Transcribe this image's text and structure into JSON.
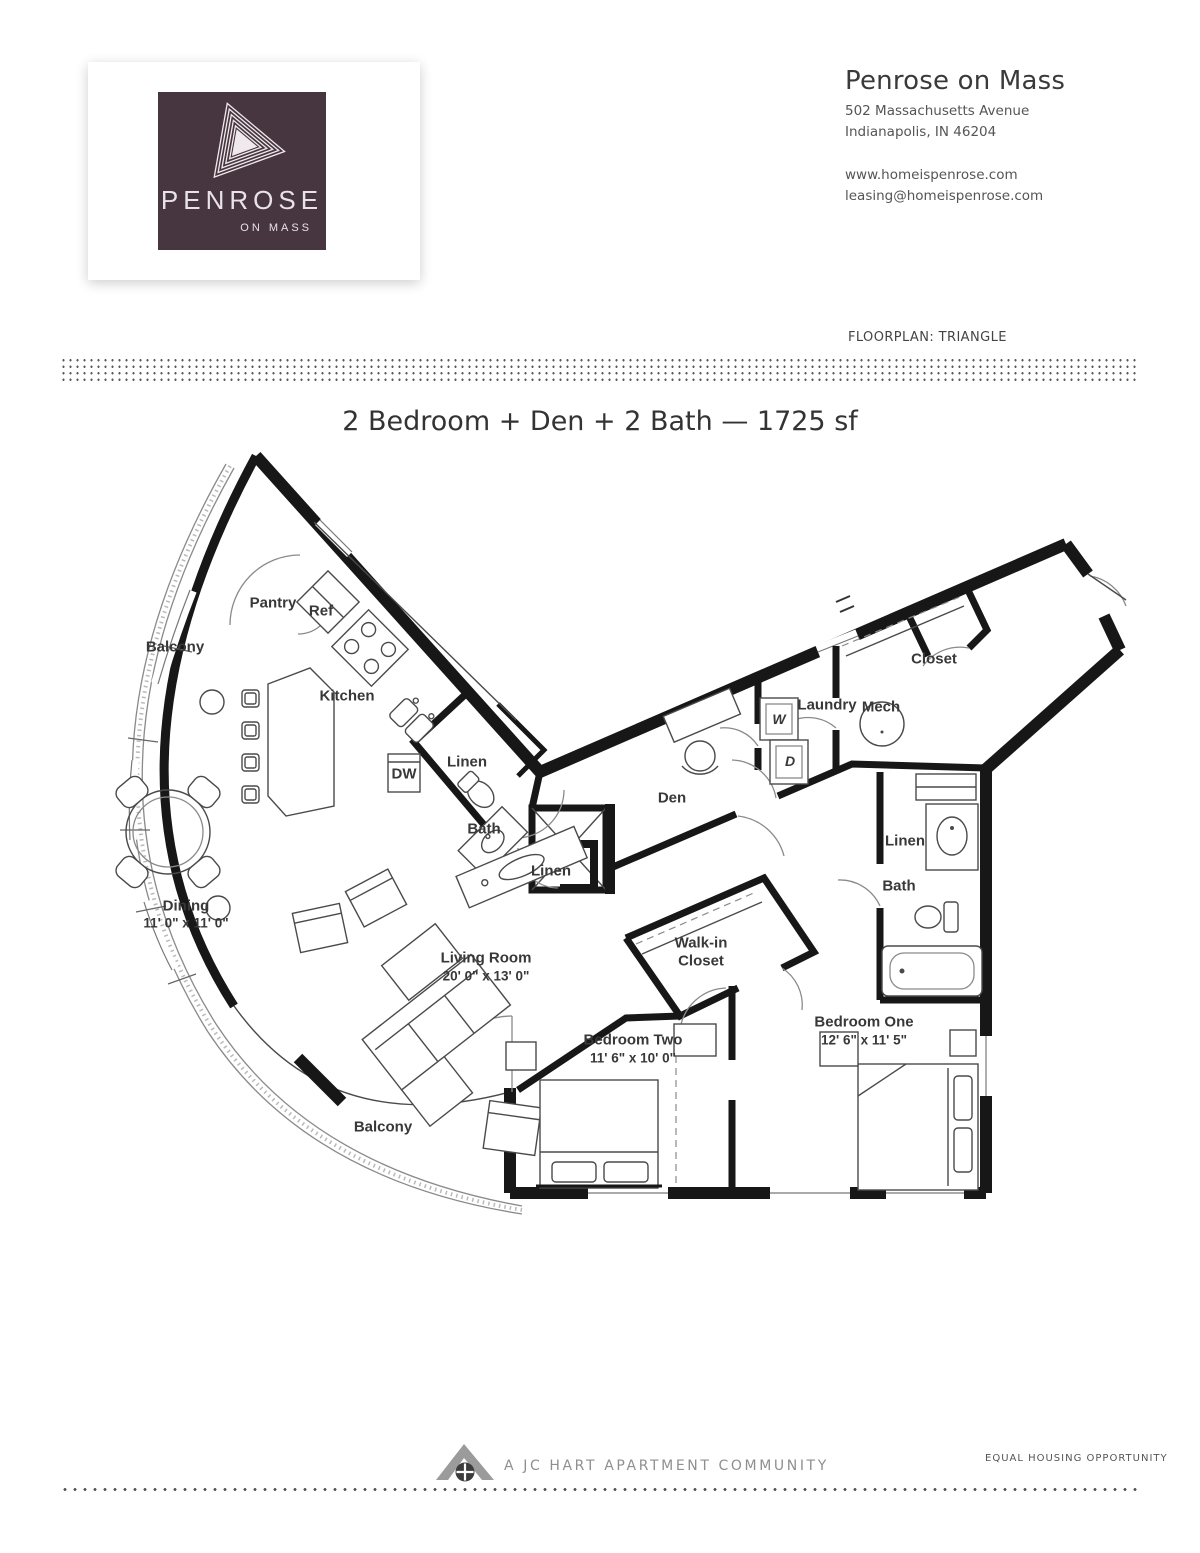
{
  "header": {
    "logo": {
      "brand": "PENROSE",
      "sub": "ON MASS",
      "bg_color": "#47363f"
    },
    "property_name": "Penrose on Mass",
    "address_line1": "502 Massachusetts Avenue",
    "address_line2": "Indianapolis, IN 46204",
    "website": "www.homeispenrose.com",
    "email": "leasing@homeispenrose.com",
    "floorplan_label": "FLOORPLAN: TRIANGLE"
  },
  "title": "2 Bedroom + Den + 2 Bath — 1725 sf",
  "plan": {
    "wall_color": "#171717",
    "labels": [
      {
        "id": "balcony-upper",
        "text": "Balcony"
      },
      {
        "id": "pantry",
        "text": "Pantry"
      },
      {
        "id": "ref",
        "text": "Ref"
      },
      {
        "id": "kitchen",
        "text": "Kitchen"
      },
      {
        "id": "dw",
        "text": "DW"
      },
      {
        "id": "linen-kitchen",
        "text": "Linen"
      },
      {
        "id": "bath-main",
        "text": "Bath"
      },
      {
        "id": "linen-hall",
        "text": "Linen"
      },
      {
        "id": "den",
        "text": "Den"
      },
      {
        "id": "washer",
        "text": "W"
      },
      {
        "id": "dryer",
        "text": "D"
      },
      {
        "id": "laundry",
        "text": "Laundry"
      },
      {
        "id": "mech",
        "text": "Mech"
      },
      {
        "id": "closet-entry",
        "text": "Closet"
      },
      {
        "id": "linen-bath",
        "text": "Linen"
      },
      {
        "id": "bath-two",
        "text": "Bath"
      },
      {
        "id": "dining",
        "text": "Dining"
      },
      {
        "id": "dining-dims",
        "text": "11' 0\" x 11' 0\""
      },
      {
        "id": "living",
        "text": "Living Room"
      },
      {
        "id": "living-dims",
        "text": "20' 0\" x 13' 0\""
      },
      {
        "id": "walkin-line1",
        "text": "Walk-in"
      },
      {
        "id": "walkin-line2",
        "text": "Closet"
      },
      {
        "id": "bedroom-two",
        "text": "Bedroom Two"
      },
      {
        "id": "bedroom-two-dims",
        "text": "11' 6\" x 10' 0\""
      },
      {
        "id": "bedroom-one",
        "text": "Bedroom One"
      },
      {
        "id": "bedroom-one-dims",
        "text": "12' 6\" x 11' 5\""
      },
      {
        "id": "balcony-lower",
        "text": "Balcony"
      }
    ]
  },
  "footer": {
    "community_line": "A JC HART APARTMENT COMMUNITY",
    "equal_housing": "EQUAL HOUSING OPPORTUNITY"
  }
}
